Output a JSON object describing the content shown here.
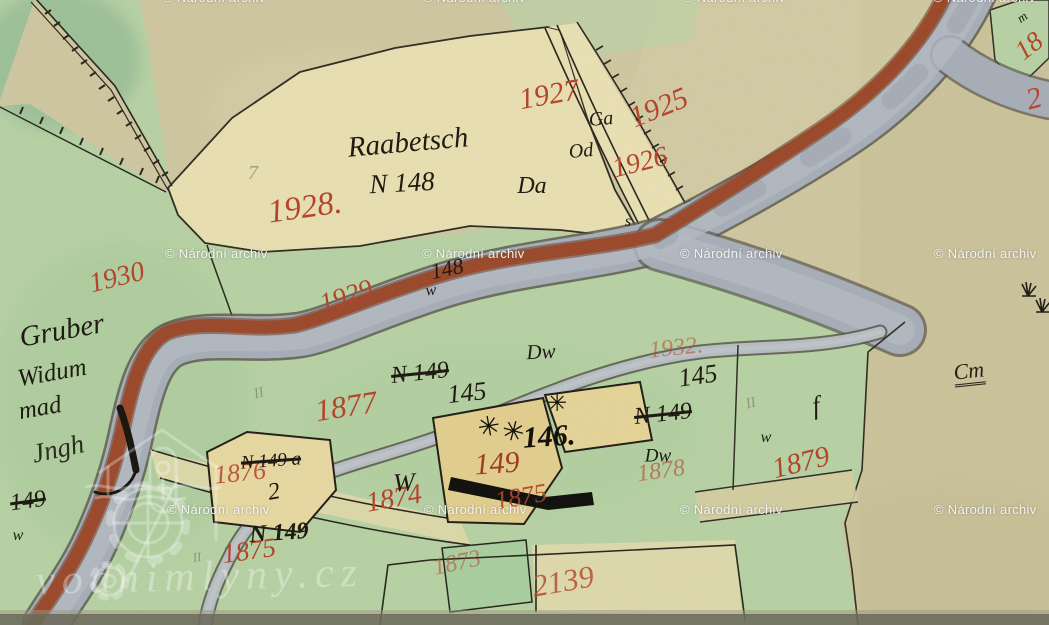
{
  "map": {
    "description": "Hand-drawn historical cadastral map scan (water mill site by a river)",
    "colors": {
      "paper": "#cfc7a0",
      "meadow_green": "#b7d2a4",
      "dark_green": "#96bd96",
      "parcel_yellow": "#e9e0b2",
      "building_yellow": "#e3cf8e",
      "river_water": "#a7aeb9",
      "river_bank": "#9c4526",
      "red_ink": "#b4452c",
      "black_ink": "#1f1a12",
      "pencil": "#868b74",
      "watermark_white": "#f5f5f5"
    },
    "watermark": {
      "text": "© Národní archiv",
      "positions": [
        [
          163,
          -10
        ],
        [
          423,
          -10
        ],
        [
          683,
          -10
        ],
        [
          933,
          -10
        ],
        [
          165,
          246
        ],
        [
          422,
          246
        ],
        [
          680,
          246
        ],
        [
          934,
          246
        ],
        [
          167,
          502
        ],
        [
          424,
          502
        ],
        [
          680,
          502
        ],
        [
          934,
          502
        ]
      ]
    },
    "logo": {
      "text": "vodnimlyny.cz",
      "icon": "watermill-house-icon",
      "x": 200,
      "y": 577
    },
    "mill_wheel_symbols": [
      {
        "glyph": "✳",
        "x": 489,
        "y": 427,
        "size": 27,
        "rot": -10
      },
      {
        "glyph": "✳",
        "x": 513,
        "y": 432,
        "size": 27,
        "rot": 15
      },
      {
        "glyph": "✳",
        "x": 557,
        "y": 403,
        "size": 24,
        "rot": 0
      }
    ],
    "labels": [
      {
        "name": "parcel-1927",
        "text": "1927",
        "x": 549,
        "y": 95,
        "size": 30,
        "rot": -10,
        "color": "#b4452c"
      },
      {
        "name": "parcel-1925",
        "text": "1925",
        "x": 659,
        "y": 108,
        "size": 30,
        "rot": -22,
        "color": "#b4452c"
      },
      {
        "name": "parcel-1926",
        "text": "1926",
        "x": 640,
        "y": 163,
        "size": 28,
        "rot": -14,
        "color": "#b4452c"
      },
      {
        "name": "parcel-1928",
        "text": "1928.",
        "x": 305,
        "y": 208,
        "size": 33,
        "rot": -8,
        "color": "#b4452c"
      },
      {
        "name": "parcel-1930",
        "text": "1930",
        "x": 117,
        "y": 278,
        "size": 28,
        "rot": -14,
        "color": "#b4452c"
      },
      {
        "name": "parcel-1929",
        "text": "1929",
        "x": 346,
        "y": 296,
        "size": 27,
        "rot": -18,
        "color": "#b4452c"
      },
      {
        "name": "parcel-1877",
        "text": "1877",
        "x": 346,
        "y": 406,
        "size": 31,
        "rot": -9,
        "color": "#b4452c"
      },
      {
        "name": "parcel-1932",
        "text": "1932.",
        "x": 676,
        "y": 348,
        "size": 24,
        "rot": -6,
        "color": "#b4452c",
        "opacity": 0.55
      },
      {
        "name": "parcel-1876",
        "text": "1876",
        "x": 240,
        "y": 473,
        "size": 26,
        "rot": -6,
        "color": "#b4452c",
        "opacity": 0.85
      },
      {
        "name": "house-149-red",
        "text": "149",
        "x": 497,
        "y": 464,
        "size": 30,
        "rot": -4,
        "color": "#9c3c20"
      },
      {
        "name": "parcel-1874",
        "text": "1874",
        "x": 394,
        "y": 499,
        "size": 28,
        "rot": -10,
        "color": "#b4452c"
      },
      {
        "name": "parcel-1875-a",
        "text": "1875",
        "x": 521,
        "y": 497,
        "size": 26,
        "rot": -10,
        "color": "#b4452c",
        "opacity": 0.9
      },
      {
        "name": "parcel-1875-b",
        "text": "1875",
        "x": 249,
        "y": 551,
        "size": 27,
        "rot": -8,
        "color": "#b4452c"
      },
      {
        "name": "parcel-1878",
        "text": "1878",
        "x": 661,
        "y": 471,
        "size": 24,
        "rot": -8,
        "color": "#b4452c",
        "opacity": 0.6
      },
      {
        "name": "parcel-1879",
        "text": "1879",
        "x": 801,
        "y": 463,
        "size": 29,
        "rot": -14,
        "color": "#b4452c"
      },
      {
        "name": "parcel-1873",
        "text": "1873",
        "x": 457,
        "y": 563,
        "size": 24,
        "rot": -12,
        "color": "#b4452c",
        "opacity": 0.55
      },
      {
        "name": "parcel-2139",
        "text": "2139",
        "x": 563,
        "y": 581,
        "size": 31,
        "rot": -10,
        "color": "#b4452c",
        "opacity": 0.8
      },
      {
        "name": "parcel-18-corner",
        "text": "18",
        "x": 1029,
        "y": 46,
        "size": 27,
        "rot": -38,
        "color": "#b4452c"
      },
      {
        "name": "parcel-2-corner",
        "text": "2",
        "x": 1034,
        "y": 99,
        "size": 30,
        "rot": -15,
        "color": "#b4452c"
      },
      {
        "name": "field-name-raabetsch",
        "text": "Raabetsch",
        "x": 408,
        "y": 143,
        "size": 29,
        "rot": -5,
        "color": "#1f1a12"
      },
      {
        "name": "house-number-n148",
        "text": "N 148",
        "x": 402,
        "y": 183,
        "size": 27,
        "rot": -3,
        "color": "#1f1a12"
      },
      {
        "name": "culture-da",
        "text": "Da",
        "x": 532,
        "y": 186,
        "size": 24,
        "rot": 0,
        "color": "#1f1a12"
      },
      {
        "name": "culture-ga",
        "text": "Ga",
        "x": 601,
        "y": 119,
        "size": 20,
        "rot": -5,
        "color": "#1f1a12"
      },
      {
        "name": "culture-od",
        "text": "Od",
        "x": 581,
        "y": 151,
        "size": 20,
        "rot": -5,
        "color": "#1f1a12"
      },
      {
        "name": "number-148",
        "text": "148",
        "x": 447,
        "y": 269,
        "size": 22,
        "rot": -12,
        "color": "#1f1a12"
      },
      {
        "name": "culture-w-1",
        "text": "w",
        "x": 431,
        "y": 291,
        "size": 16,
        "rot": -5,
        "color": "#1f1a12"
      },
      {
        "name": "culture-dw-1",
        "text": "Dw",
        "x": 541,
        "y": 352,
        "size": 21,
        "rot": -3,
        "color": "#1f1a12"
      },
      {
        "name": "number-n149-struck-1",
        "text": "N 149",
        "x": 420,
        "y": 373,
        "size": 24,
        "rot": -6,
        "color": "#1f1a12",
        "class": "strike"
      },
      {
        "name": "number-145-a",
        "text": "145",
        "x": 467,
        "y": 393,
        "size": 26,
        "rot": -6,
        "color": "#1f1a12"
      },
      {
        "name": "number-145-b",
        "text": "145",
        "x": 698,
        "y": 376,
        "size": 26,
        "rot": -8,
        "color": "#1f1a12"
      },
      {
        "name": "number-n149-struck-2",
        "text": "N 149",
        "x": 663,
        "y": 414,
        "size": 24,
        "rot": -6,
        "color": "#1f1a12",
        "class": "strike"
      },
      {
        "name": "culture-dw-2",
        "text": "Dw",
        "x": 658,
        "y": 456,
        "size": 19,
        "rot": 0,
        "color": "#1f1a12"
      },
      {
        "name": "culture-w-2",
        "text": "w",
        "x": 766,
        "y": 438,
        "size": 16,
        "rot": 0,
        "color": "#1f1a12"
      },
      {
        "name": "number-n149a-struck",
        "text": "N 149 a",
        "x": 271,
        "y": 461,
        "size": 19,
        "rot": -4,
        "color": "#1f1a12",
        "class": "strike"
      },
      {
        "name": "mark-2-black",
        "text": "2",
        "x": 274,
        "y": 492,
        "size": 24,
        "rot": -10,
        "color": "#1f1a12"
      },
      {
        "name": "number-n149",
        "text": "N 149",
        "x": 279,
        "y": 533,
        "size": 24,
        "rot": -4,
        "color": "#1f1a12",
        "class": "bold"
      },
      {
        "name": "culture-w-big-1",
        "text": "W",
        "x": 404,
        "y": 483,
        "size": 26,
        "rot": -3,
        "color": "#1f1a12"
      },
      {
        "name": "number-146",
        "text": "146.",
        "x": 549,
        "y": 437,
        "size": 30,
        "rot": -4,
        "color": "#14100a",
        "class": "bold"
      },
      {
        "name": "owner-gruber",
        "text": "Gruber",
        "x": 62,
        "y": 331,
        "size": 29,
        "rot": -10,
        "color": "#1f1a12"
      },
      {
        "name": "owner-widum",
        "text": "Widum",
        "x": 52,
        "y": 373,
        "size": 25,
        "rot": -10,
        "color": "#1f1a12"
      },
      {
        "name": "owner-mad",
        "text": "mad",
        "x": 40,
        "y": 408,
        "size": 25,
        "rot": -10,
        "color": "#1f1a12"
      },
      {
        "name": "owner-flourish",
        "text": "Jngh",
        "x": 58,
        "y": 449,
        "size": 27,
        "rot": -12,
        "color": "#1f1a12",
        "opacity": 0.9
      },
      {
        "name": "number-149-struck-edge",
        "text": "149",
        "x": 28,
        "y": 501,
        "size": 24,
        "rot": -8,
        "color": "#1f1a12",
        "class": "strike"
      },
      {
        "name": "culture-w-3",
        "text": "w",
        "x": 18,
        "y": 536,
        "size": 16,
        "rot": 0,
        "color": "#1f1a12"
      },
      {
        "name": "mark-cm-underlined",
        "text": "Cm",
        "x": 969,
        "y": 373,
        "size": 22,
        "rot": -6,
        "color": "#241e14",
        "class": "underline"
      },
      {
        "name": "mark-f-flourish",
        "text": "f",
        "x": 816,
        "y": 406,
        "size": 26,
        "rot": -10,
        "color": "#1f1a12"
      },
      {
        "name": "mark-s-small",
        "text": "s",
        "x": 628,
        "y": 222,
        "size": 16,
        "rot": 0,
        "color": "#1f1a12"
      },
      {
        "name": "mark-m-squiggle",
        "text": "m",
        "x": 1022,
        "y": 17,
        "size": 13,
        "rot": -35,
        "color": "#1f1a12"
      },
      {
        "name": "pencil-7",
        "text": "7",
        "x": 253,
        "y": 173,
        "size": 20,
        "rot": 0,
        "color": "#868b74",
        "opacity": 0.75
      },
      {
        "name": "pencil-ii-1",
        "text": "II",
        "x": 259,
        "y": 394,
        "size": 15,
        "rot": -15,
        "color": "#868b74",
        "opacity": 0.8
      },
      {
        "name": "pencil-ii-2",
        "text": "II",
        "x": 751,
        "y": 404,
        "size": 15,
        "rot": -15,
        "color": "#868b74",
        "opacity": 0.8
      },
      {
        "name": "pencil-ii-3",
        "text": "II",
        "x": 197,
        "y": 557,
        "size": 13,
        "rot": -10,
        "color": "#868b74",
        "opacity": 0.8
      }
    ]
  }
}
